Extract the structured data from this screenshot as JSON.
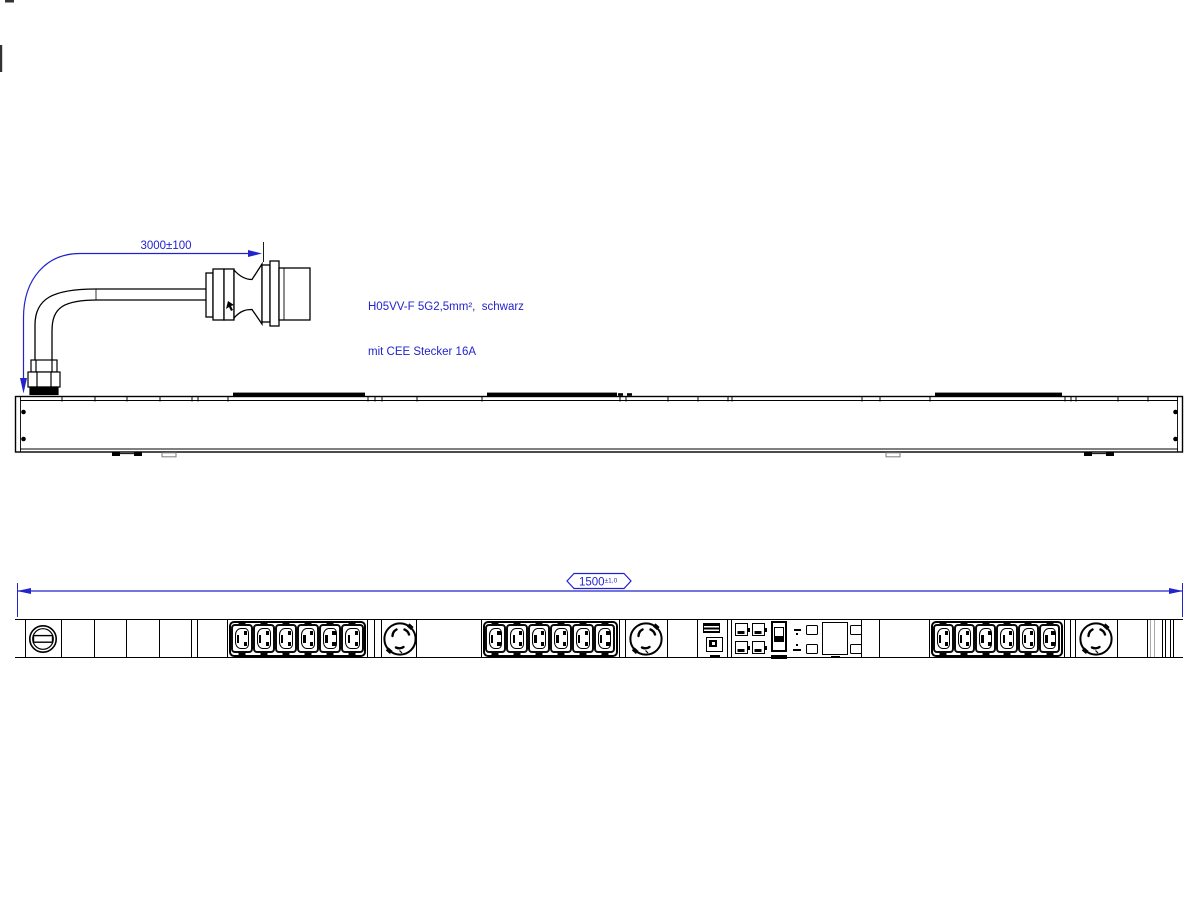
{
  "drawing": {
    "title": "PDU with CEE plug - technical drawing",
    "background_color": "#ffffff",
    "line_color": "#000000",
    "annotation_color": "#2323cd"
  },
  "annotations": {
    "cable_length_dim": "3000±100",
    "cable_spec_line1": "H05VV-F 5G2,5mm²,  schwarz",
    "cable_spec_line2": "mit CEE Stecker 16A",
    "overall_length_value": "1500",
    "overall_length_tolerance": "±1,0"
  },
  "front_view": {
    "segments": [
      {
        "type": "cap",
        "x": 15,
        "w": 11
      },
      {
        "type": "fuse",
        "x": 26,
        "w": 36
      },
      {
        "type": "blank",
        "x": 62,
        "w": 33
      },
      {
        "type": "blank",
        "x": 95,
        "w": 32
      },
      {
        "type": "blank",
        "x": 127,
        "w": 33
      },
      {
        "type": "blank",
        "x": 160,
        "w": 32
      },
      {
        "type": "narrow",
        "x": 192,
        "w": 6
      },
      {
        "type": "blank",
        "x": 198,
        "w": 30
      },
      {
        "type": "c13-group",
        "x": 228,
        "w": 140,
        "count": 6
      },
      {
        "type": "narrow",
        "x": 368,
        "w": 7
      },
      {
        "type": "narrow",
        "x": 375,
        "w": 7
      },
      {
        "type": "twistlock",
        "x": 382,
        "w": 35
      },
      {
        "type": "blank",
        "x": 417,
        "w": 65
      },
      {
        "type": "c13-group",
        "x": 482,
        "w": 138,
        "count": 6
      },
      {
        "type": "narrow",
        "x": 620,
        "w": 6
      },
      {
        "type": "twistlock",
        "x": 626,
        "w": 42
      },
      {
        "type": "blank",
        "x": 668,
        "w": 30
      },
      {
        "type": "module-a",
        "x": 698,
        "w": 30
      },
      {
        "type": "narrow",
        "x": 728,
        "w": 4
      },
      {
        "type": "module-b",
        "x": 732,
        "w": 130
      },
      {
        "type": "blank",
        "x": 862,
        "w": 18
      },
      {
        "type": "blank",
        "x": 880,
        "w": 50
      },
      {
        "type": "c13-group",
        "x": 930,
        "w": 135,
        "count": 6
      },
      {
        "type": "narrow",
        "x": 1065,
        "w": 6
      },
      {
        "type": "narrow",
        "x": 1071,
        "w": 5
      },
      {
        "type": "twistlock",
        "x": 1076,
        "w": 42
      },
      {
        "type": "blank",
        "x": 1118,
        "w": 30
      },
      {
        "type": "cap-right",
        "x": 1148,
        "w": 35
      }
    ],
    "outlet_total_c13": 18,
    "outlet_total_locking": 3
  }
}
